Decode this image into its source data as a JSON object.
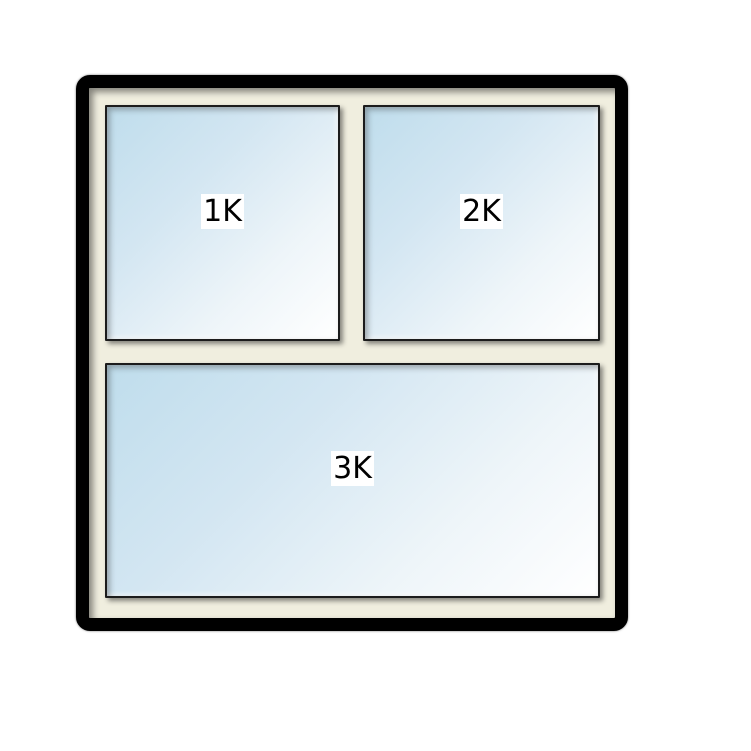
{
  "window": {
    "panes": [
      {
        "id": "pane-1k",
        "label": "1K"
      },
      {
        "id": "pane-2k",
        "label": "2K"
      },
      {
        "id": "pane-3k",
        "label": "3K"
      }
    ],
    "colors": {
      "outer_frame": "#000000",
      "casing": "#f0eedf",
      "pane_border": "#1c1c1c",
      "glass_top_left": "#bfddec",
      "glass_bottom_right": "#ffffff",
      "label_background": "#ffffff",
      "label_text": "#000000",
      "page_background": "#ffffff"
    }
  }
}
